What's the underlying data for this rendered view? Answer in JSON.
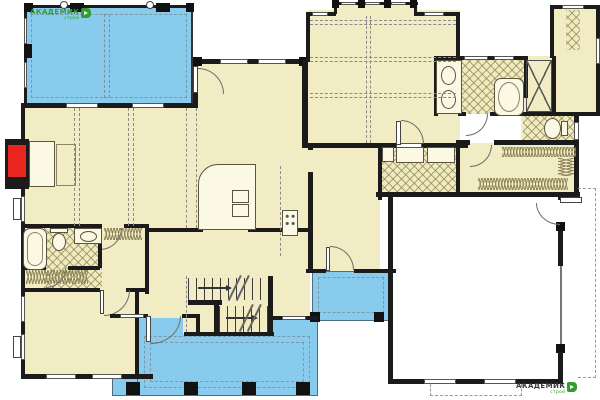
{
  "branding": {
    "logo_top_left": {
      "text": "АКАДЕМИК",
      "subtext": "строй"
    },
    "logo_bottom_right": {
      "text": "АКАДЕМИК",
      "subtext": "строй"
    }
  },
  "palette": {
    "background": "#FFFFFF",
    "room_fill": "#F2ECC4",
    "porch_fill": "#88CBEC",
    "wall": "#1B1B1B",
    "fireplace_red": "#E8251F",
    "hatch_line": "#8F855A",
    "logo_green": "#2F9E2F",
    "garage_fill": "#FEFEFE"
  },
  "plan": {
    "kind": "architectural-floor-plan",
    "areas": [
      "deck",
      "great-room",
      "breakfast-kitchen",
      "master-bedroom",
      "master-bathroom",
      "water-closet",
      "walk-in-closet",
      "laundry",
      "hallway",
      "garage",
      "dining-room",
      "foyer",
      "stairs",
      "bedroom",
      "bathroom-2",
      "closets",
      "front-porch",
      "rear-stoop"
    ],
    "fixtures": [
      "fireplace",
      "kitchen-island",
      "island-sink",
      "range",
      "bathtub",
      "toilet",
      "vanity-sink",
      "double-vanity",
      "oval-tub",
      "shower",
      "washer",
      "dryer",
      "closet-rods",
      "stair-arrows",
      "garage-side-door",
      "front-door"
    ]
  }
}
